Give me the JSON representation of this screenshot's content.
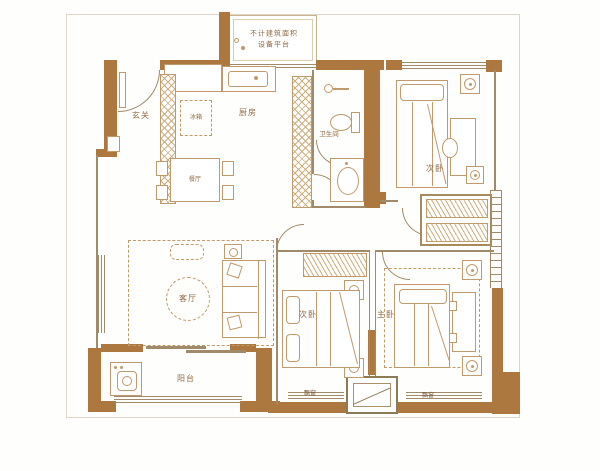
{
  "colors": {
    "wall": "#ad7740",
    "furn": "#bf9a6c",
    "line": "#a08a6a",
    "label": "#8f6a44",
    "hatch": "#cfae7e"
  },
  "labels": {
    "entry": "玄关",
    "kitchen": "厨房",
    "fridge": "冰箱",
    "dining": "餐厅",
    "bathroom": "卫生间",
    "bedroom_top_right": "次卧",
    "living": "客厅",
    "balcony": "阳台",
    "bedroom_mid": "次卧",
    "master": "主卧",
    "bay_left": "飘窗",
    "bay_right": "飘窗",
    "platform_line1": "不计建筑面积",
    "platform_line2": "设备平台"
  }
}
